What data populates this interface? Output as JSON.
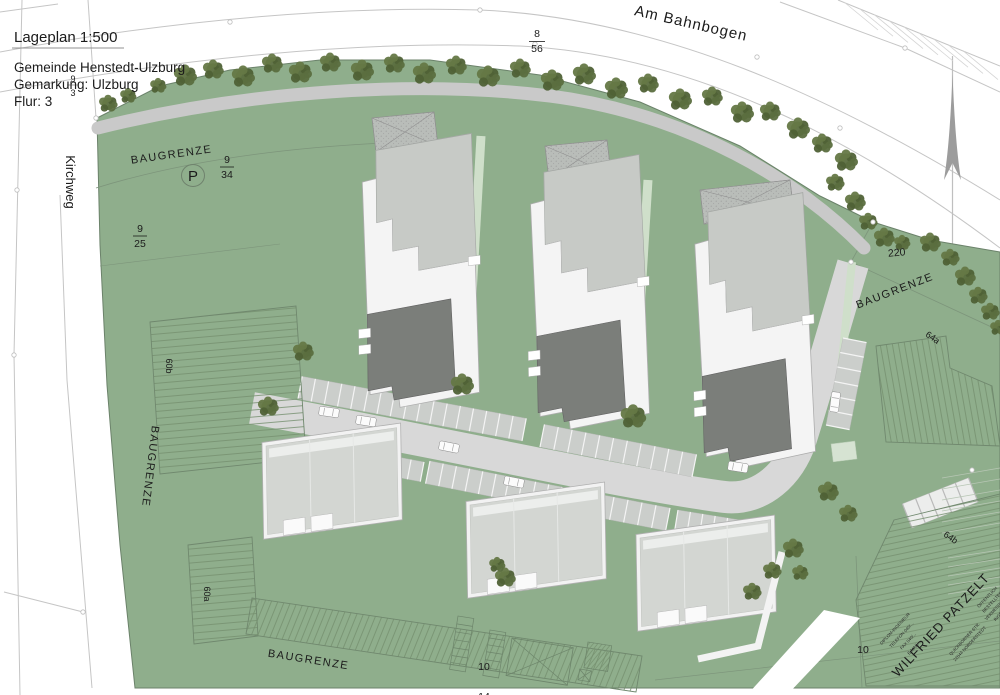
{
  "title_block": {
    "title": "Lageplan 1:500",
    "line1": "Gemeinde Henstedt-Ulzburg",
    "line2": "Gemarkung: Ulzburg",
    "line3": "Flur: 3"
  },
  "streets": {
    "top": "Am Bahnbogen",
    "left": "Kirchweg"
  },
  "boundary": {
    "label": "BAUGRENZE"
  },
  "symbols": {
    "parking": "P"
  },
  "parcels": {
    "f8_56": {
      "n": "8",
      "d": "56"
    },
    "f9_34": {
      "n": "9",
      "d": "34"
    },
    "f9_25": {
      "n": "9",
      "d": "25"
    },
    "f9_3": {
      "n": "9",
      "d": "3"
    },
    "n220": "220",
    "n64a": "64a",
    "n64b": "64b",
    "n60a": "60a",
    "n60b": "60b",
    "n10a": "10",
    "n14a": "14",
    "n10b": "10"
  },
  "stamp": {
    "name": "WILFRIED PATZELT",
    "left_lines": [
      "DIPLOM-INGENIEUR",
      "TELEFON 040/...",
      "FAX 040/...",
      "E-MAIL ..."
    ],
    "right_lines": [
      "ÖFFENTLICH",
      "BESTELLTER",
      "VERMESSUNGS-",
      "INGENIEUR"
    ],
    "address_lines": [
      "QUICKBORNER STR.",
      "22844 NORDERSTEDT"
    ]
  },
  "colors": {
    "site_green": "#8FAE8C",
    "green_dark": "#6B826A",
    "road": "#D8D8D8",
    "sidewalk": "#C9C9C9",
    "stall": "#CBCECB",
    "roof_light": "#C7CAC6",
    "roof_dark": "#7B7E7A",
    "roof_white": "#F4F4F4",
    "south_roof": "#D3D6D2",
    "tree": "#5B6E3F",
    "tree_dark": "#4F6136",
    "tree_light": "#657846",
    "line": "#C5C5C5",
    "hatch": "#75906F",
    "court": "#B9BDB9",
    "path_green": "#CFDFCA"
  }
}
